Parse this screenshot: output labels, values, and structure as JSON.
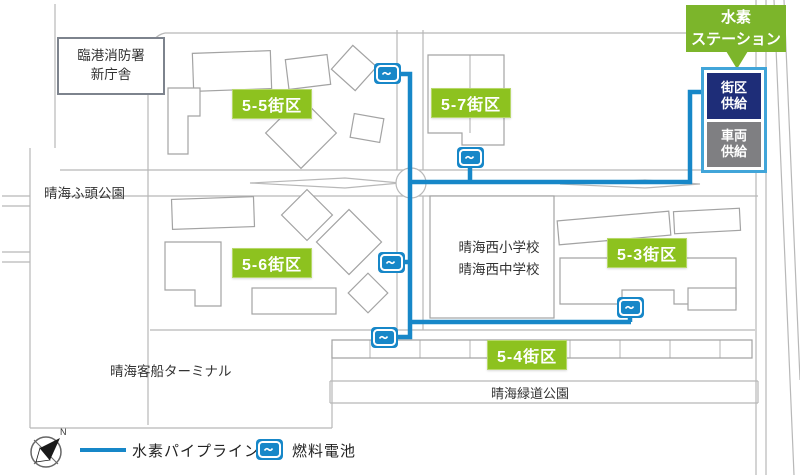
{
  "callout": {
    "line1": "水素",
    "line2": "ステーション"
  },
  "station": {
    "block_supply": "街区\n供給",
    "vehicle_supply": "車両\n供給"
  },
  "blocks": [
    {
      "label": "5-5街区"
    },
    {
      "label": "5-7街区"
    },
    {
      "label": "5-6街区"
    },
    {
      "label": "5-3街区"
    },
    {
      "label": "5-4街区"
    }
  ],
  "places": {
    "fire_station": "臨港消防署\n新庁舎",
    "pier_park": "晴海ふ頭公園",
    "elementary_school": "晴海西小学校",
    "junior_high_school": "晴海西中学校",
    "cruise_terminal": "晴海客船ターミナル",
    "green_road_park": "晴海緑道公園"
  },
  "legend": {
    "pipeline": "水素パイプライン",
    "fuel_cell": "燃料電池",
    "compass_north": "N"
  },
  "colors": {
    "block_label_green": "#8dc21f",
    "callout_green": "#7cb52b",
    "pipeline_blue": "#1787c8",
    "station_border_blue": "#41a5d9",
    "block_supply_navy": "#1e2d78",
    "vehicle_supply_gray": "#7f7f82"
  }
}
